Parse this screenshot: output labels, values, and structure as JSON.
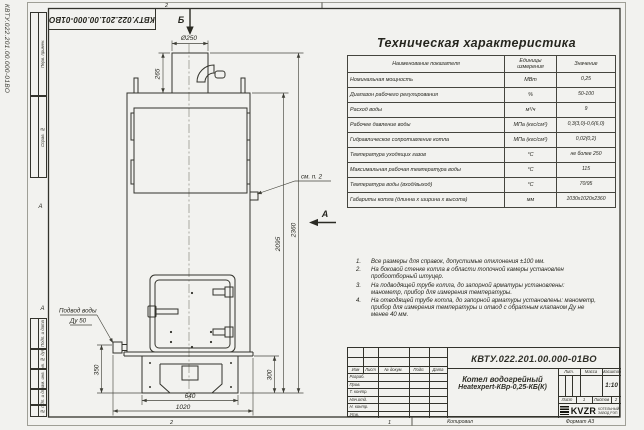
{
  "doc": {
    "number": "КВТУ.022.201.00.000-01ВО",
    "copied_label": "Копировал",
    "format_label": "Формат А3"
  },
  "margin": {
    "fields": [
      "Перв. примен.",
      "Справ. №",
      "Подп. и дата",
      "Инв. № дубл.",
      "Взам. инв. №",
      "Подп. и дата",
      "Инв. № подл."
    ],
    "zone_letter_mid": "А",
    "zone_letter_low": "А",
    "zone_number_top": "2",
    "zone_number_bottom_left": "2",
    "zone_number_bottom_right": "1"
  },
  "drawing": {
    "view_b": "Б",
    "view_a": "А",
    "dims": {
      "chimney_dia": "Ø250",
      "chimney_h": "265",
      "body_h": "2095",
      "total_h": "2360",
      "inlet_h": "350",
      "base_w": "640",
      "boiler_w": "1020",
      "base_h": "300"
    },
    "callouts": {
      "see_note": "см. п. 2",
      "water_supply": "Подвод воды",
      "water_dn": "Ду 50"
    }
  },
  "spec_table": {
    "title": "Техническая характеристика",
    "col_name": "Наименование показателя",
    "col_units": "Единицы измерения",
    "col_value": "Значение",
    "rows": [
      [
        "Номинальная мощность",
        "МВт",
        "0,25"
      ],
      [
        "Диапазон рабочего регулирования",
        "%",
        "50-100"
      ],
      [
        "Расход воды",
        "м³/ч",
        "9"
      ],
      [
        "Рабочее давление воды",
        "МПа (кгс/см²)",
        "0,3(3,0)-0,6(6,0)"
      ],
      [
        "Гидравлическое сопротивление котла",
        "МПа (кгс/см²)",
        "0,02(0,2)"
      ],
      [
        "Температура уходящих газов",
        "°С",
        "не более 250"
      ],
      [
        "Максимальная рабочая температура воды",
        "°С",
        "115"
      ],
      [
        "Температура воды (вход/выход)",
        "°С",
        "70/95"
      ],
      [
        "Габариты котла (длинна х ширина х высота)",
        "мм",
        "1030х1020х2360"
      ]
    ]
  },
  "notes": {
    "items": [
      {
        "num": "1.",
        "text": "Все размеры для справок, допустимые отклонения ±100 мм."
      },
      {
        "num": "2.",
        "text": "На боковой стенке котла в области топочной камеры установлен пробоотборный штуцер."
      },
      {
        "num": "3.",
        "text": "На подводящей трубе котла, до запорной арматуры установлены: манометр, прибор для измерения температуры."
      },
      {
        "num": "4.",
        "text": "На отводящей трубе котла, до запорной арматуры установлены: манометр, прибор для измерения температуры и отвод с обратным клапаном Ду не менее 40 мм."
      }
    ]
  },
  "title_block": {
    "doc_number": "КВТУ.022.201.00.000-01ВО",
    "header_cols": [
      "Изм",
      "Лист",
      "№ докум.",
      "Подп.",
      "Дата"
    ],
    "sign_rows": [
      "Разраб.",
      "Пров.",
      "Т. контр.",
      "Нач.отд.",
      "Н. контр.",
      "Утв."
    ],
    "product_line1": "Котел водогрейный",
    "product_line2": "Heatexpert-КВр-0,25-КБ(К)",
    "lit_label": "Лит.",
    "mass_label": "Масса",
    "scale_label": "Масштаб",
    "scale_value": "1:10",
    "sheet_label": "Лист",
    "sheet_value": "1",
    "sheets_label": "Листов",
    "sheets_value": "2",
    "company_logo": "KVZR",
    "company_line1": "КОТЕЛЬНЫЙ",
    "company_line2": "ЗАВОД РЭП"
  }
}
